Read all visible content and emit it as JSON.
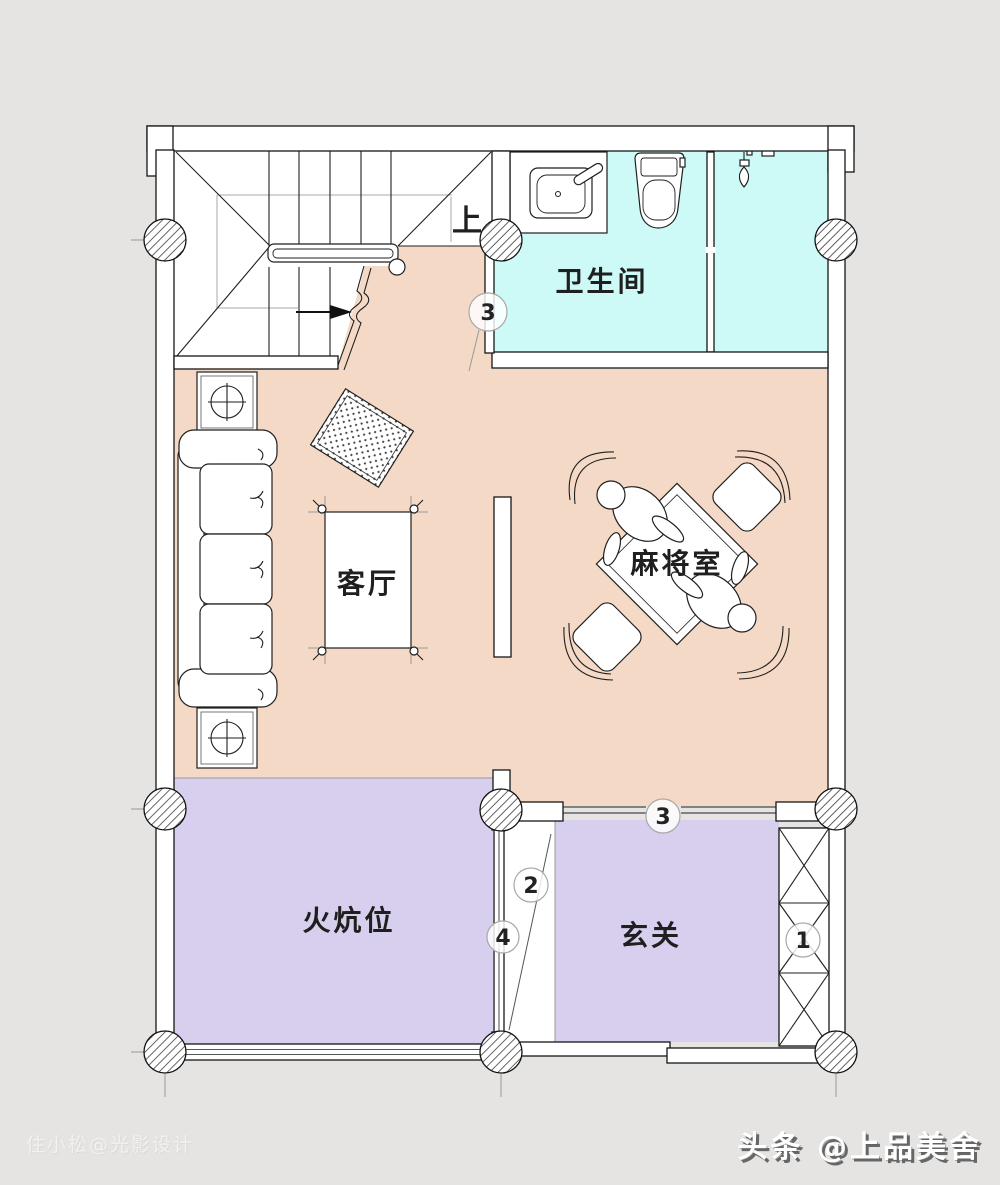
{
  "rooms": {
    "bathroom": "卫生间",
    "living": "客厅",
    "mahjong": "麻将室",
    "kang": "火炕位",
    "entry": "玄关"
  },
  "stairs": {
    "direction_label": "上"
  },
  "markers": {
    "bathroom_door": "3",
    "entry_top_window": "3",
    "corridor_upper": "2",
    "corridor_lower": "4",
    "entry_cabinet": "1"
  },
  "watermarks": {
    "designer": "住小松@光影设计",
    "publisher": "头条 @上品美舍"
  },
  "colors": {
    "background": "#e5e4e2",
    "floor_living": "#f4d9c6",
    "floor_bathroom": "#cdfaf6",
    "floor_soft": "#d7cfed",
    "wall": "#ffffff",
    "line": "#1f1f1f"
  }
}
